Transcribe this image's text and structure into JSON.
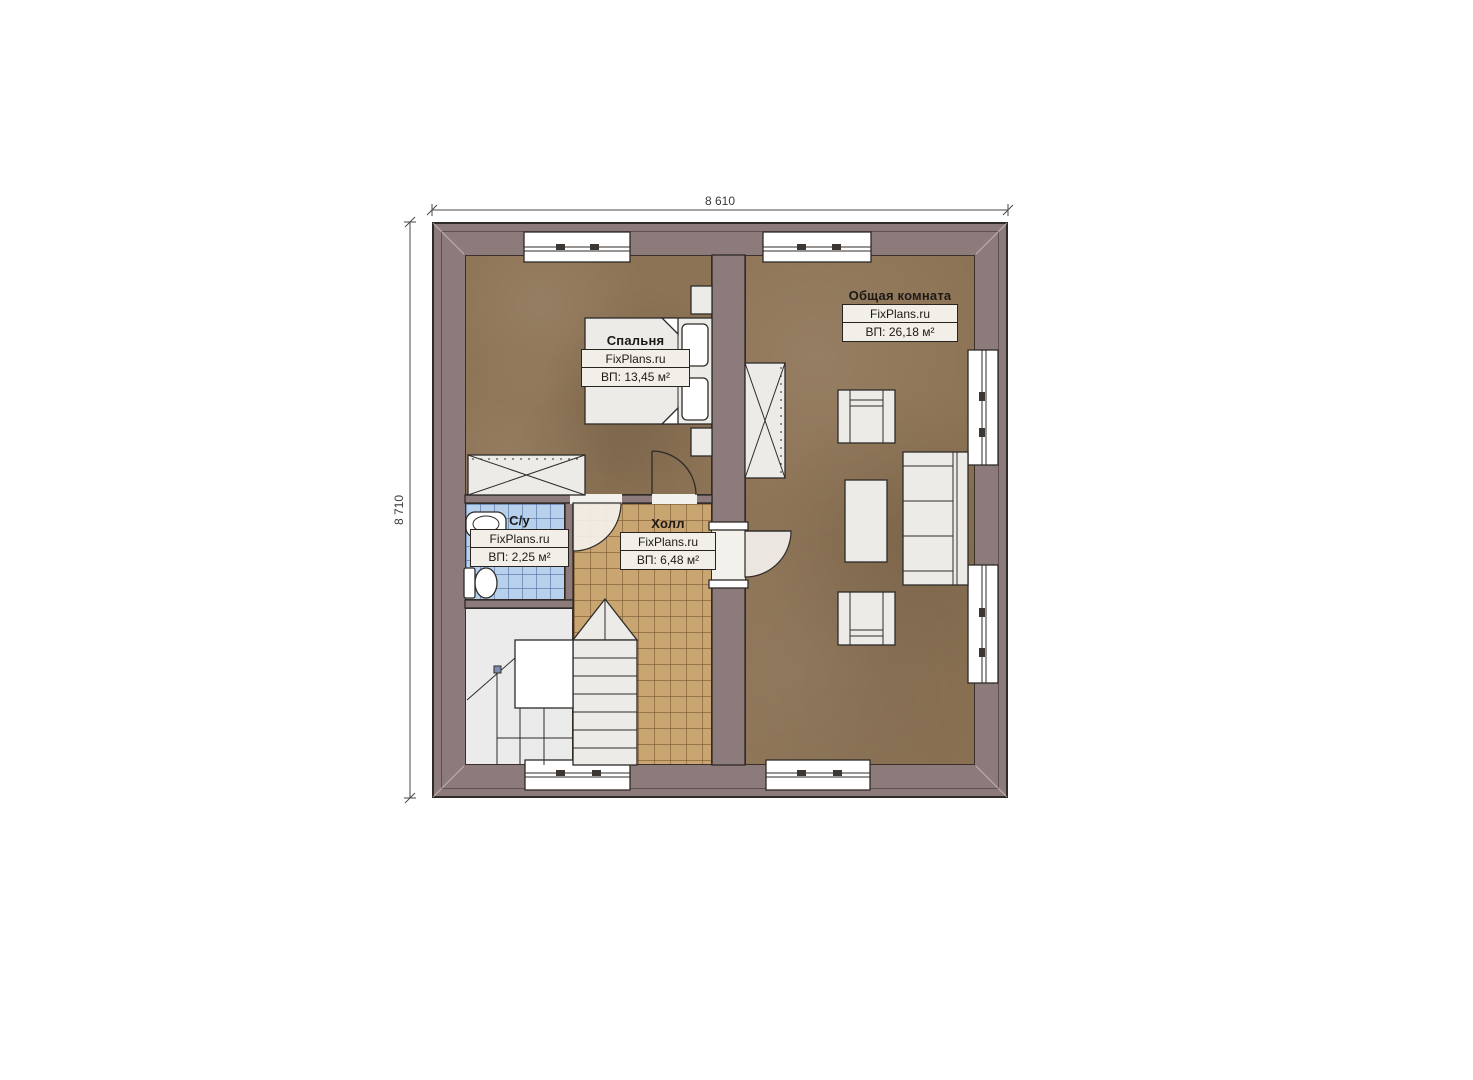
{
  "dimensions": {
    "top": "8 610",
    "left": "8 710"
  },
  "brand": "FixPlans.ru",
  "rooms": {
    "bedroom": {
      "name": "Спальня",
      "area": "ВП: 13,45 м²"
    },
    "living": {
      "name": "Общая комната",
      "area": "ВП: 26,18 м²"
    },
    "bath": {
      "name": "С/у",
      "area": "ВП: 2,25 м²"
    },
    "hall": {
      "name": "Холл",
      "area": "ВП: 6,48 м²"
    }
  },
  "colors": {
    "wall": "#8d7a7a",
    "wall_dark_line": "#3a302b",
    "floor_wood": "#8d7355",
    "tile_hall": "#c9a571",
    "tile_bath": "#b7d1ec",
    "stairs": "#ebebeb",
    "furniture": "#edebe7",
    "outline": "#2e2b28",
    "dim_line": "#4a4a4a",
    "plate_bg": "#f2efe8"
  }
}
